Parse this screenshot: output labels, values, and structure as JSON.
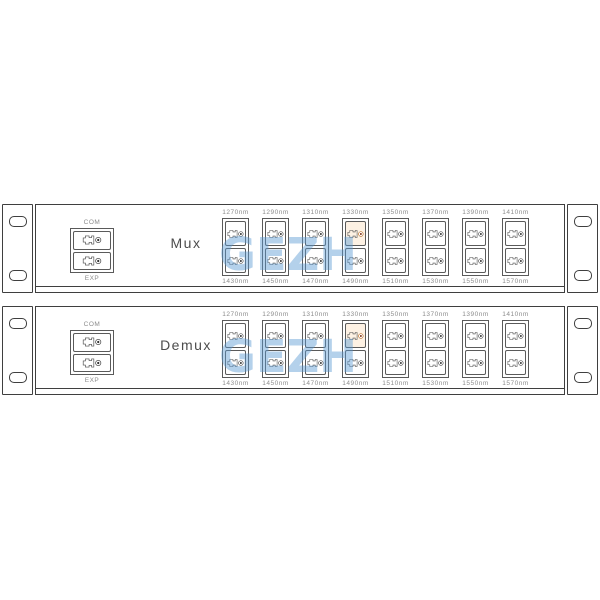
{
  "watermark_text": "GEZH",
  "colors": {
    "outline": "#3f3f3f",
    "port_border": "#5a5a5a",
    "label": "#8c8c8c",
    "title": "#4d4d4d",
    "watermark": "#5b9bd5",
    "special_ring": "#b5651d",
    "special_dot": "#7a2e12",
    "special_fill": "#fdf1e3"
  },
  "panels": [
    {
      "id": "mux",
      "title": "Mux",
      "com_label": "COM",
      "exp_label": "EXP",
      "columns": [
        {
          "top_label": "1270nm",
          "bottom_label": "1430nm",
          "special_top": false
        },
        {
          "top_label": "1290nm",
          "bottom_label": "1450nm",
          "special_top": false
        },
        {
          "top_label": "1310nm",
          "bottom_label": "1470nm",
          "special_top": false
        },
        {
          "top_label": "1330nm",
          "bottom_label": "1490nm",
          "special_top": true
        },
        {
          "top_label": "1350nm",
          "bottom_label": "1510nm",
          "special_top": false
        },
        {
          "top_label": "1370nm",
          "bottom_label": "1530nm",
          "special_top": false
        },
        {
          "top_label": "1390nm",
          "bottom_label": "1550nm",
          "special_top": false
        },
        {
          "top_label": "1410nm",
          "bottom_label": "1570nm",
          "special_top": false
        }
      ]
    },
    {
      "id": "demux",
      "title": "Demux",
      "com_label": "COM",
      "exp_label": "EXP",
      "columns": [
        {
          "top_label": "1270nm",
          "bottom_label": "1430nm",
          "special_top": false
        },
        {
          "top_label": "1290nm",
          "bottom_label": "1450nm",
          "special_top": false
        },
        {
          "top_label": "1310nm",
          "bottom_label": "1470nm",
          "special_top": false
        },
        {
          "top_label": "1330nm",
          "bottom_label": "1490nm",
          "special_top": true
        },
        {
          "top_label": "1350nm",
          "bottom_label": "1510nm",
          "special_top": false
        },
        {
          "top_label": "1370nm",
          "bottom_label": "1530nm",
          "special_top": false
        },
        {
          "top_label": "1390nm",
          "bottom_label": "1550nm",
          "special_top": false
        },
        {
          "top_label": "1410nm",
          "bottom_label": "1570nm",
          "special_top": false
        }
      ]
    }
  ]
}
